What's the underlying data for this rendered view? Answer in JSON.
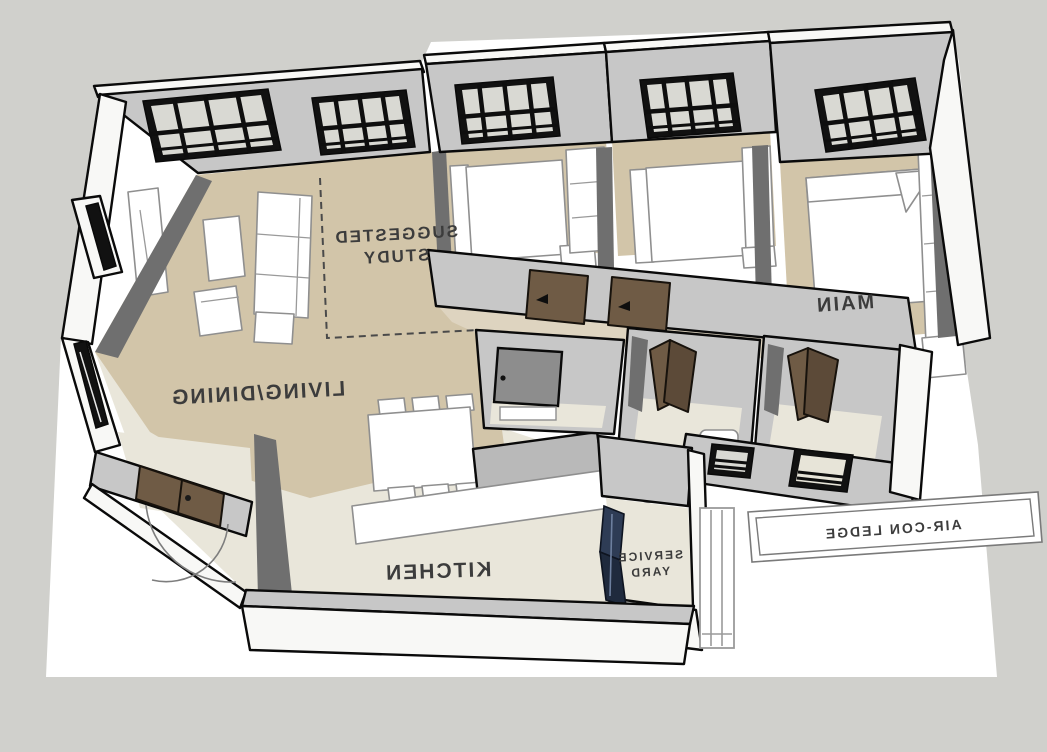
{
  "labels": {
    "suggested_study_l1": "SUGGESTED",
    "suggested_study_l2": "STUDY",
    "living_dining": "LIVING/DINING",
    "kitchen": "KITCHEN",
    "main": "MAIN",
    "service_yard_l1": "SERVICE",
    "service_yard_l2": "YARD",
    "aircon_ledge": "AIR-CON LEDGE",
    "bath": "BATH"
  },
  "palette": {
    "background": "#d0d0cc",
    "sheet": "#ffffff",
    "wall_top": "#c7c7c7",
    "wall_side": "#f8f8f6",
    "wall_dark": "#6f6f6f",
    "slab_gray": "#b9b9b9",
    "floor_tan": "#d2c5a9",
    "floor_pale": "#e9e6da",
    "door_brown": "#6f5b45",
    "door_navy": "#2e3c55",
    "frame_black": "#111111"
  }
}
